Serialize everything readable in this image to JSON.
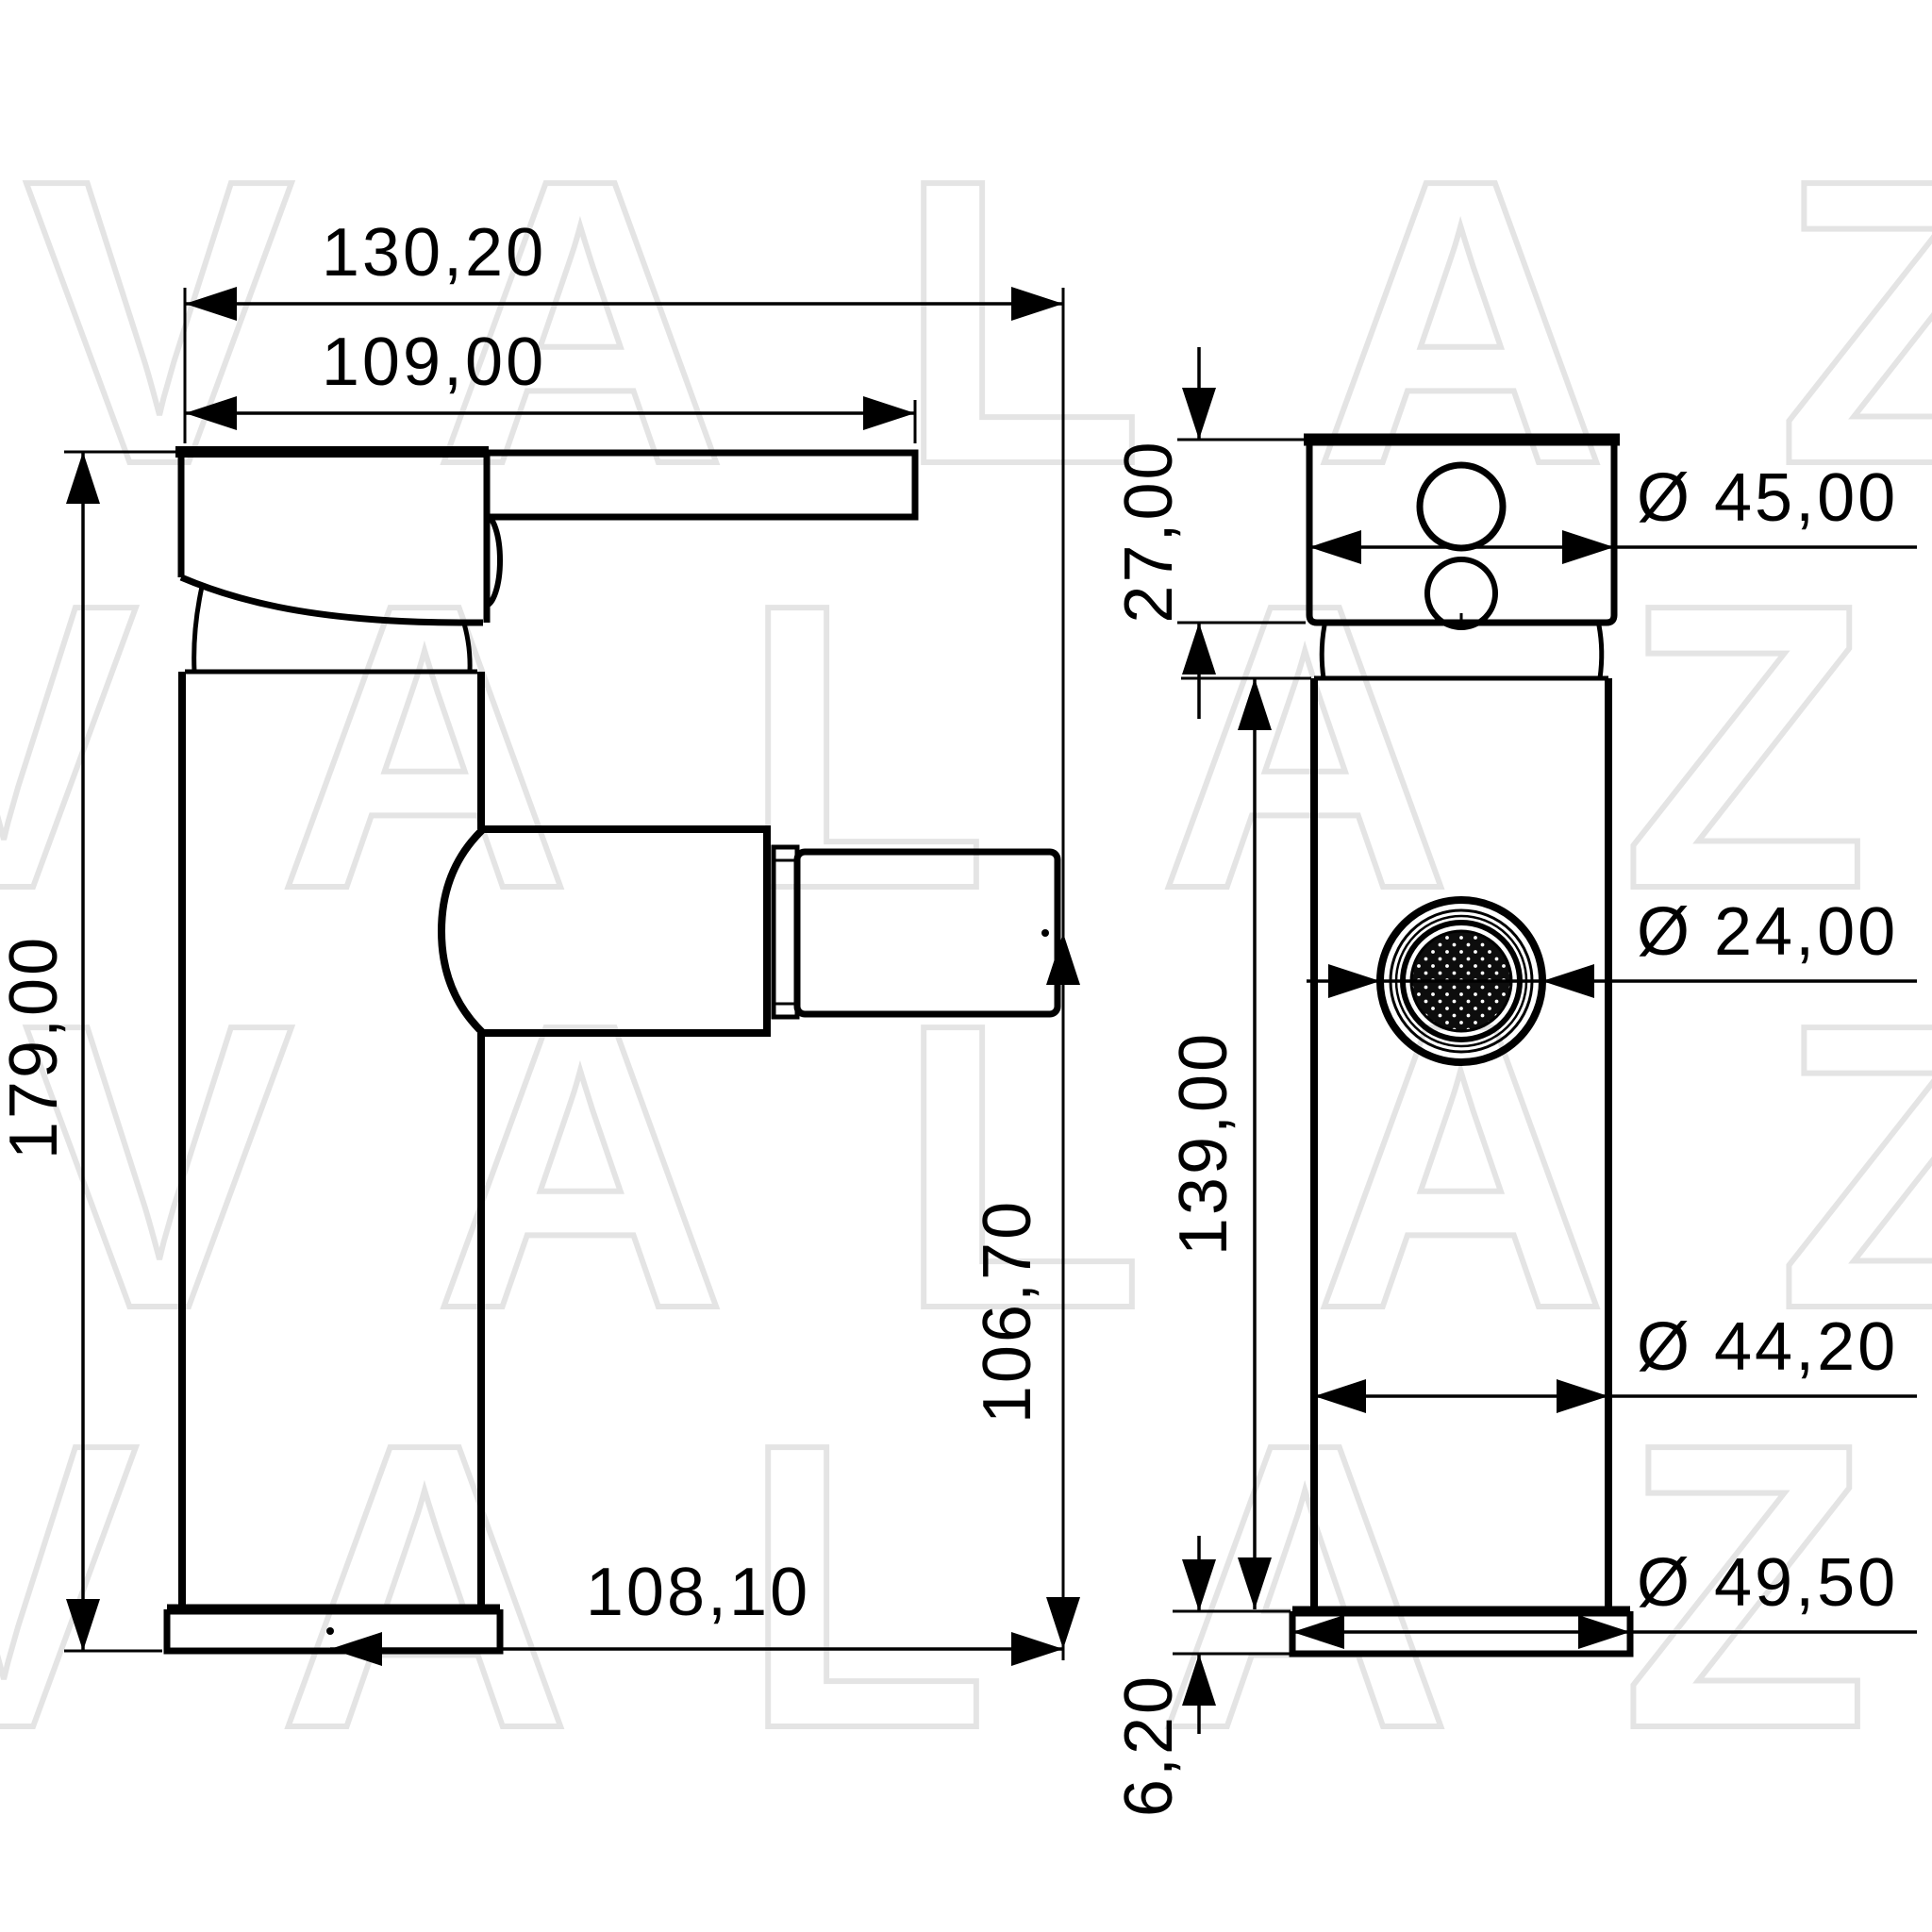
{
  "watermark": {
    "text": "VALAZ"
  },
  "colors": {
    "line": "#000000",
    "watermark": "#e4e4e4",
    "background": "#ffffff"
  },
  "diagram": {
    "type": "technical-drawing",
    "subject": "single-lever basin/bidet mixer tap, two orthographic views with dimensions (mm)",
    "dims": {
      "side": {
        "total_length": "130,20",
        "lever_length": "109,00",
        "total_height": "179,00",
        "outlet_height": "106,70",
        "spout_reach": "108,10"
      },
      "front": {
        "handle_height": "27,00",
        "handle_diameter": "Ø 45,00",
        "aerator_diameter": "Ø 24,00",
        "body_height": "139,00",
        "body_diameter": "Ø 44,20",
        "base_height": "6,20",
        "base_diameter": "Ø 49,50"
      }
    }
  }
}
